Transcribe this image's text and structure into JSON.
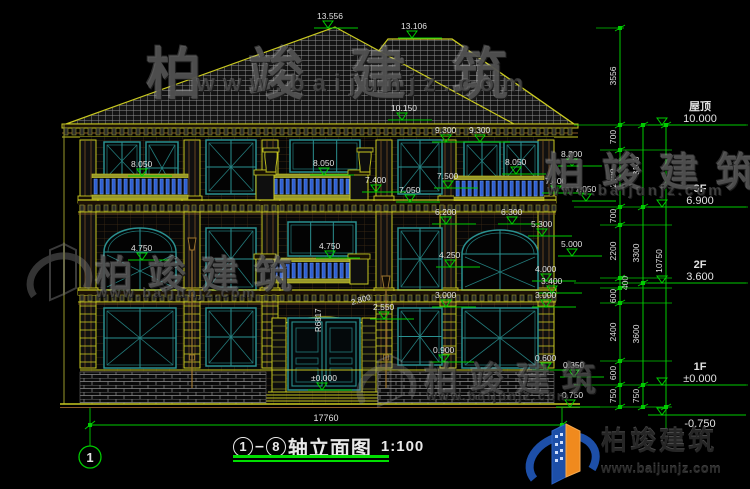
{
  "drawing": {
    "title": {
      "axis_from": "1",
      "axis_to": "8",
      "name": "轴立面图",
      "scale": "1:100"
    },
    "overall_width_dim": "17760",
    "axis_bubble": "1"
  },
  "levels": [
    {
      "label": "屋顶",
      "value": "10.000",
      "y": 125
    },
    {
      "label": "3F",
      "value": "6.900",
      "y": 207
    },
    {
      "label": "2F",
      "value": "3.600",
      "y": 283
    },
    {
      "label": "1F",
      "value": "±0.000",
      "y": 385
    },
    {
      "label": "",
      "value": "-0.750",
      "y": 415,
      "below": true
    }
  ],
  "dim_columns": [
    {
      "x": 620,
      "ticks": [
        28,
        125,
        150,
        207,
        225,
        278,
        288,
        303,
        361,
        385,
        407
      ],
      "labels": [
        {
          "t": "3556",
          "y": 76
        },
        {
          "t": "700",
          "y": 137
        },
        {
          "t": "2400",
          "y": 178
        },
        {
          "t": "700",
          "y": 216
        },
        {
          "t": "2200",
          "y": 251
        },
        {
          "t": "400",
          "y": 283,
          "dx": 12
        },
        {
          "t": "600",
          "y": 296
        },
        {
          "t": "2400",
          "y": 332
        },
        {
          "t": "600",
          "y": 373
        },
        {
          "t": "750",
          "y": 396
        }
      ]
    },
    {
      "x": 643,
      "ticks": [
        125,
        207,
        283,
        385,
        407
      ],
      "labels": [
        {
          "t": "3100",
          "y": 166
        },
        {
          "t": "3300",
          "y": 253
        },
        {
          "t": "3600",
          "y": 334
        },
        {
          "t": "750",
          "y": 396
        }
      ]
    },
    {
      "x": 666,
      "ticks": [
        125,
        407
      ],
      "labels": [
        {
          "t": "10750",
          "y": 261
        }
      ]
    }
  ],
  "markers": [
    {
      "t": "13.556",
      "x": 314,
      "y": 28
    },
    {
      "t": "13.106",
      "x": 398,
      "y": 38
    },
    {
      "t": "10.150",
      "x": 388,
      "y": 120
    },
    {
      "t": "9.300",
      "x": 432,
      "y": 142
    },
    {
      "t": "9.300",
      "x": 466,
      "y": 142
    },
    {
      "t": "8.050",
      "x": 128,
      "y": 176
    },
    {
      "t": "8.050",
      "x": 310,
      "y": 175
    },
    {
      "t": "8.050",
      "x": 502,
      "y": 174
    },
    {
      "t": "8.300",
      "x": 558,
      "y": 166
    },
    {
      "t": "7.500",
      "x": 434,
      "y": 188
    },
    {
      "t": "7.400",
      "x": 362,
      "y": 192
    },
    {
      "t": "7.400",
      "x": 542,
      "y": 193
    },
    {
      "t": "7.050",
      "x": 396,
      "y": 202
    },
    {
      "t": "7.050",
      "x": 572,
      "y": 201
    },
    {
      "t": "6.200",
      "x": 432,
      "y": 224
    },
    {
      "t": "6.300",
      "x": 498,
      "y": 224
    },
    {
      "t": "5.300",
      "x": 528,
      "y": 236
    },
    {
      "t": "5.000",
      "x": 558,
      "y": 256
    },
    {
      "t": "4.750",
      "x": 128,
      "y": 260
    },
    {
      "t": "4.750",
      "x": 316,
      "y": 258
    },
    {
      "t": "4.250",
      "x": 436,
      "y": 267
    },
    {
      "t": "4.000",
      "x": 532,
      "y": 281
    },
    {
      "t": "3.400",
      "x": 538,
      "y": 293
    },
    {
      "t": "3.000",
      "x": 432,
      "y": 307
    },
    {
      "t": "3.000",
      "x": 532,
      "y": 307
    },
    {
      "t": "2.550",
      "x": 370,
      "y": 319
    },
    {
      "t": "0.900",
      "x": 430,
      "y": 362
    },
    {
      "t": "0.600",
      "x": 532,
      "y": 370
    },
    {
      "t": "0.350",
      "x": 560,
      "y": 377
    },
    {
      "t": "±0.000",
      "x": 308,
      "y": 390
    },
    {
      "t": "-0.750",
      "x": 556,
      "y": 407
    }
  ],
  "rotated_notes": [
    {
      "t": "2.800",
      "x": 352,
      "y": 305,
      "rot": -16
    },
    {
      "t": "R6817",
      "x": 321,
      "y": 332,
      "rot": -90
    }
  ],
  "watermark": {
    "company": "柏竣建筑",
    "website": "www.baijunjz.com"
  },
  "logo": {
    "company": "柏竣建筑",
    "website": "www.baijunjz.com"
  },
  "colors": {
    "dim_green": "#00cc00",
    "cad_yellow": "#c8c820",
    "trim_brown": "#8a5a28",
    "frame_teal": "#2a9090",
    "baluster_blue": "#2f5fd0",
    "text_white": "#e2e2e2",
    "logo_blue": "#1d4fa8",
    "logo_orange": "#f08a1e",
    "tile_gray": "#8f8f8f"
  }
}
